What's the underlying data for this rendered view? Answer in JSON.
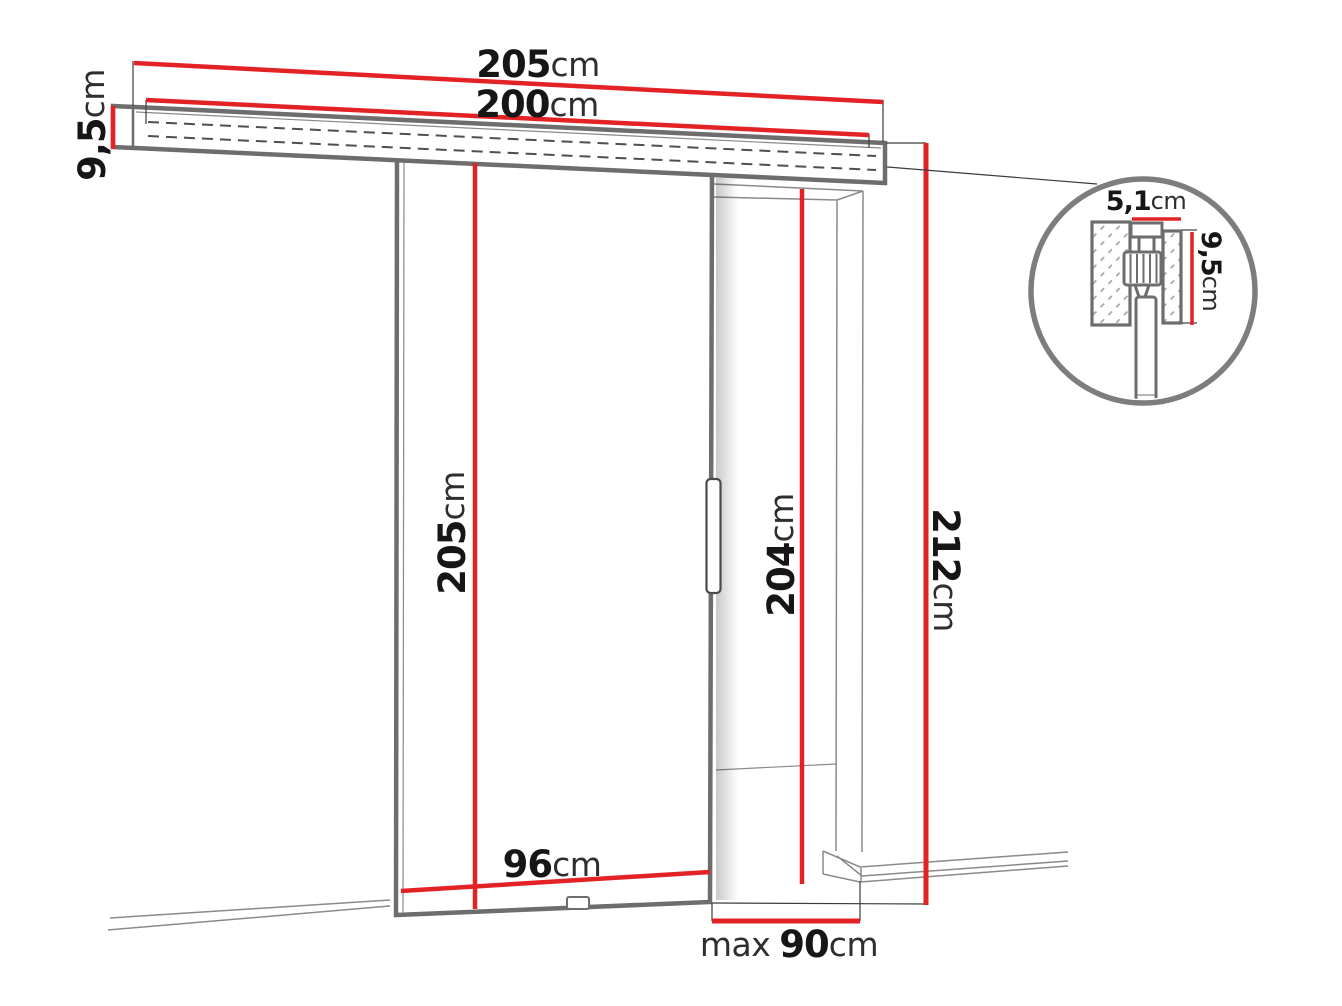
{
  "meta": {
    "description": "Technical dimension diagram of a wall-mounted sliding door system with track cross-section detail"
  },
  "colors": {
    "red": "#e32225",
    "outline": "#6d6d6d",
    "thin": "#8a8a8a",
    "text": "#161616",
    "unit": "#2e2e2e"
  },
  "labels": {
    "track_length": {
      "value": "205",
      "unit": "cm"
    },
    "rail_length": {
      "value": "200",
      "unit": "cm"
    },
    "track_height": {
      "value": "9,5",
      "unit": "cm"
    },
    "door_height": {
      "value": "205",
      "unit": "cm"
    },
    "opening_height": {
      "value": "204",
      "unit": "cm"
    },
    "total_height": {
      "value": "212",
      "unit": "cm"
    },
    "door_width": {
      "value": "96",
      "unit": "cm"
    },
    "max_opening_width": {
      "prefix": "max",
      "value": "90",
      "unit": "cm"
    },
    "detail_track_width": {
      "value": "5,1",
      "unit": "cm"
    },
    "detail_track_height": {
      "value": "9,5",
      "unit": "cm"
    }
  }
}
